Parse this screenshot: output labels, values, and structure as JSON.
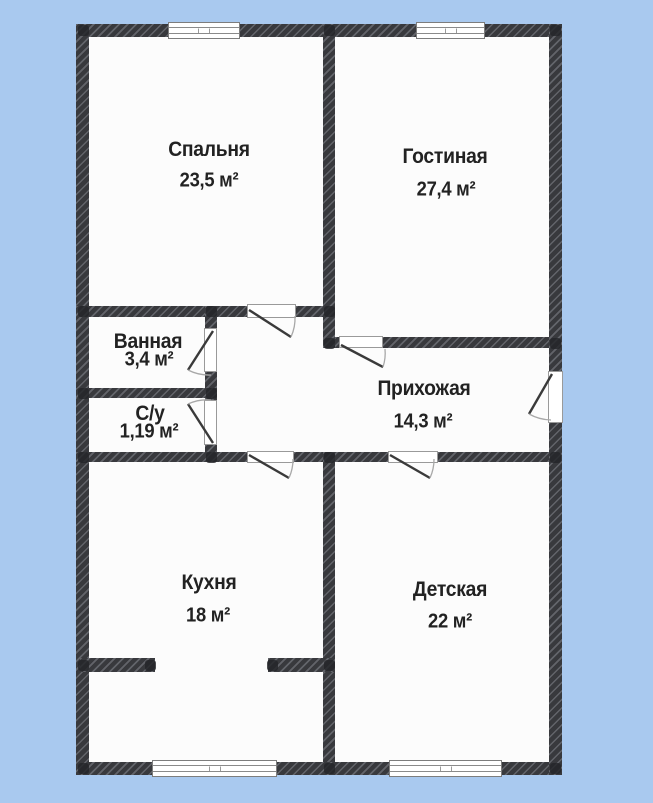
{
  "colors": {
    "background": "#a9c9ef",
    "wall": "#38393d",
    "floor": "#fcfcfc",
    "text": "#222222"
  },
  "plan_type": "floor-plan",
  "rooms": [
    {
      "name": "Спальня",
      "area": "23,5 м²"
    },
    {
      "name": "Гостиная",
      "area": "27,4 м²"
    },
    {
      "name": "Ванная",
      "area": "3,4 м²"
    },
    {
      "name": "С/у",
      "area": "1,19 м²"
    },
    {
      "name": "Прихожая",
      "area": "14,3 м²"
    },
    {
      "name": "Кухня",
      "area": "18 м²"
    },
    {
      "name": "Детская",
      "area": "22 м²"
    }
  ]
}
